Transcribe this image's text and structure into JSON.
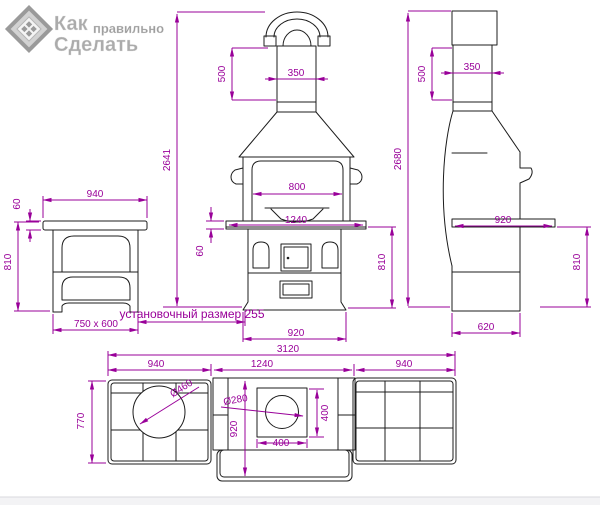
{
  "logo": {
    "word1": "Как",
    "word2": "правильно",
    "word3": "Сделать"
  },
  "colors": {
    "dimension_line": "#990099",
    "drawing_line": "#1c1c1c",
    "logo_gray": "#ababab"
  },
  "drawing": {
    "front": {
      "total_height": "2641",
      "chimney_height": "500",
      "chimney_width": "350",
      "opening_width": "800",
      "counter_width": "1240",
      "counter_thickness": "60",
      "body_height": "810",
      "base_width": "920",
      "install_note": "установочный размер 255"
    },
    "side": {
      "total_height": "2680",
      "chimney_height": "500",
      "chimney_width": "350",
      "shelf_width": "920",
      "body_height": "810",
      "base_depth": "620"
    },
    "table": {
      "top_width": "940",
      "top_thickness": "60",
      "height": "810",
      "base_size": "750 x 600"
    },
    "plan": {
      "total_width": "3120",
      "left_width": "940",
      "center_width": "1240",
      "right_width": "940",
      "left_depth": "770",
      "center_depth": "920",
      "grill_hole_dia": "Ø460",
      "flue_hole_dia": "Ø280",
      "flue_square_width": "400",
      "flue_square_height": "400"
    }
  }
}
